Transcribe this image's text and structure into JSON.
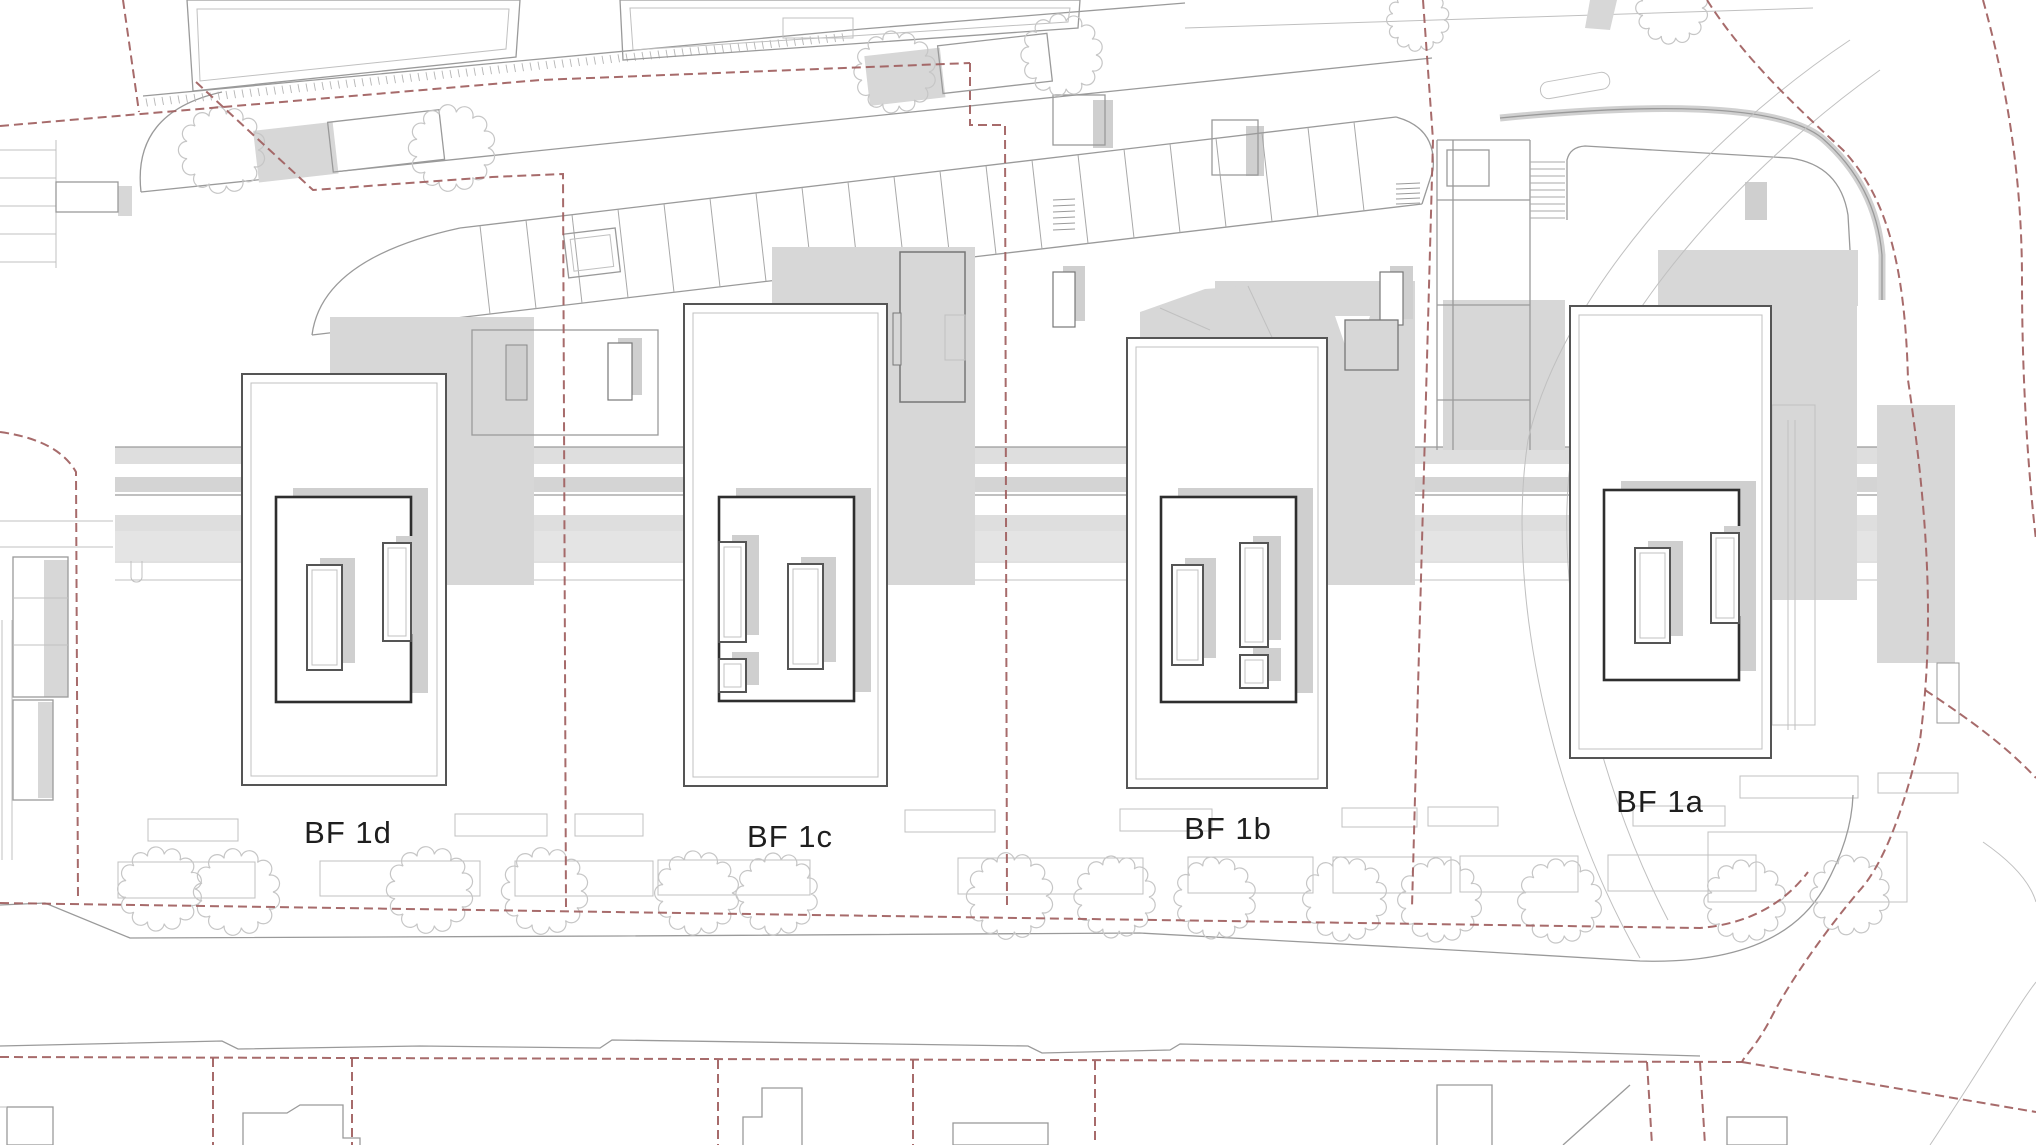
{
  "drawing": {
    "type": "architectural-site-plan",
    "description": "Roof-level site plan with four building fields, boundary lines, parking strip, street and trees"
  },
  "buildings": [
    {
      "id": "bf1d",
      "label": "BF 1d"
    },
    {
      "id": "bf1c",
      "label": "BF 1c"
    },
    {
      "id": "bf1b",
      "label": "BF 1b"
    },
    {
      "id": "bf1a",
      "label": "BF 1a"
    }
  ],
  "palette": {
    "background": "#ffffff",
    "boundary_red": "#a05e5e",
    "shadow_gray": "#d7d7d7",
    "line_gray": "#9a9a9a",
    "light_line_gray": "#c0c0c0",
    "label_color": "#1e1e1e"
  },
  "trees": {
    "street_row": [
      {
        "cx": 160,
        "cy": 889,
        "r": 35
      },
      {
        "cx": 237,
        "cy": 892,
        "r": 36
      },
      {
        "cx": 430,
        "cy": 890,
        "r": 36
      },
      {
        "cx": 545,
        "cy": 891,
        "r": 36
      },
      {
        "cx": 697,
        "cy": 893,
        "r": 35
      },
      {
        "cx": 777,
        "cy": 894,
        "r": 34
      },
      {
        "cx": 1010,
        "cy": 896,
        "r": 36
      },
      {
        "cx": 1115,
        "cy": 897,
        "r": 34
      },
      {
        "cx": 1215,
        "cy": 898,
        "r": 34
      },
      {
        "cx": 1345,
        "cy": 899,
        "r": 35
      },
      {
        "cx": 1440,
        "cy": 900,
        "r": 35
      },
      {
        "cx": 1560,
        "cy": 901,
        "r": 35
      },
      {
        "cx": 1745,
        "cy": 901,
        "r": 34
      },
      {
        "cx": 1850,
        "cy": 895,
        "r": 33
      }
    ],
    "garden_row": [
      {
        "cx": 222,
        "cy": 150,
        "r": 36
      },
      {
        "cx": 452,
        "cy": 148,
        "r": 36
      },
      {
        "cx": 895,
        "cy": 72,
        "r": 34
      },
      {
        "cx": 1062,
        "cy": 55,
        "r": 34
      },
      {
        "cx": 1418,
        "cy": 20,
        "r": 26
      },
      {
        "cx": 1672,
        "cy": 8,
        "r": 30
      }
    ]
  },
  "parking": {
    "stall_count": 20,
    "start_x": 480,
    "step": 46
  },
  "hatch": {
    "tick_count": 88
  }
}
